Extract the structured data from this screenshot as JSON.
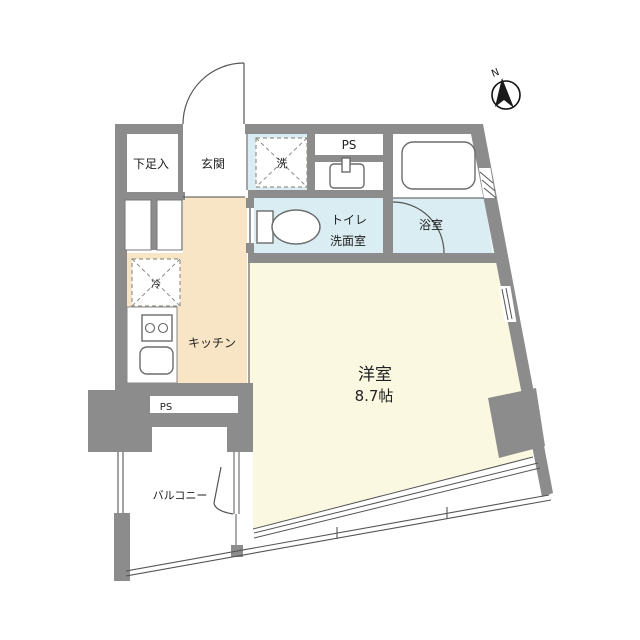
{
  "plan": {
    "type": "apartment-floor-plan",
    "compass": {
      "label": "N"
    },
    "rooms": {
      "shoe_storage": {
        "label": "下足入"
      },
      "entrance": {
        "label": "玄関"
      },
      "washer": {
        "label": "洗"
      },
      "pipe_space_top": {
        "label": "PS"
      },
      "toilet_washroom": {
        "label_line1": "トイレ",
        "label_line2": "洗面室"
      },
      "bathroom": {
        "label": "浴室"
      },
      "refrigerator": {
        "label": "冷"
      },
      "kitchen": {
        "label": "キッチン"
      },
      "western_room": {
        "label": "洋室",
        "size_label": "8.7帖"
      },
      "pipe_space_bottom": {
        "label": "PS"
      },
      "balcony": {
        "label": "バルコニー"
      }
    },
    "colors": {
      "wall": "#8c8c8c",
      "wet_area_floor": "#daedf3",
      "main_room_floor": "#fbf8e1",
      "kitchen_floor": "#f8e5c5",
      "line": "#555555",
      "text": "#222222"
    }
  }
}
